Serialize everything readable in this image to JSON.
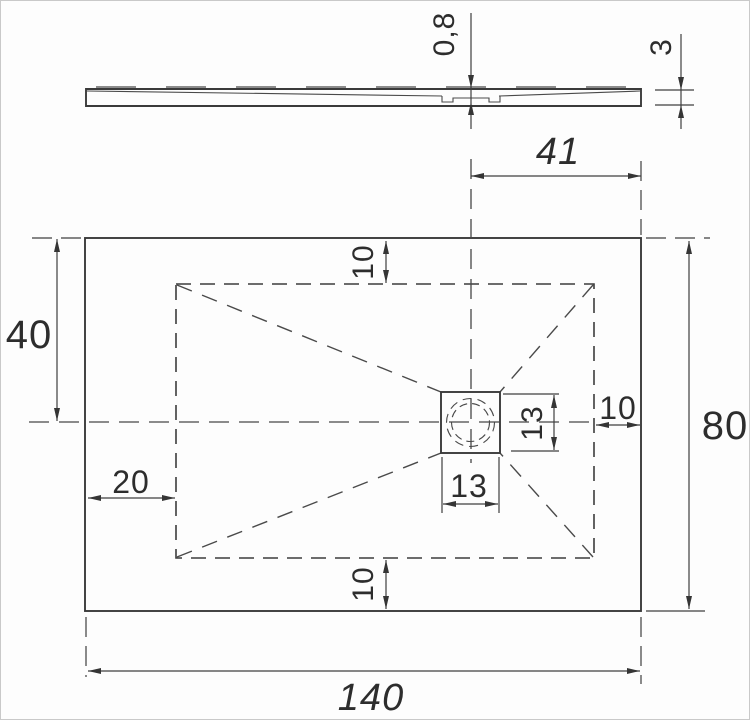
{
  "drawing": {
    "type": "shower-tray-technical-drawing",
    "line_color": "#3a3a3a",
    "background": "#fdfdfd",
    "side_view": {
      "slope_depth": "0,8",
      "thickness": "3"
    },
    "plan_view": {
      "overall_width": "140",
      "overall_depth": "80",
      "centerline_from_top": "40",
      "drain_center_to_right_edge": "41",
      "slope_border_top": "10",
      "slope_border_bottom": "10",
      "slope_border_right": "10",
      "slope_border_left": "20",
      "drain_width": "13",
      "drain_depth": "13"
    }
  }
}
